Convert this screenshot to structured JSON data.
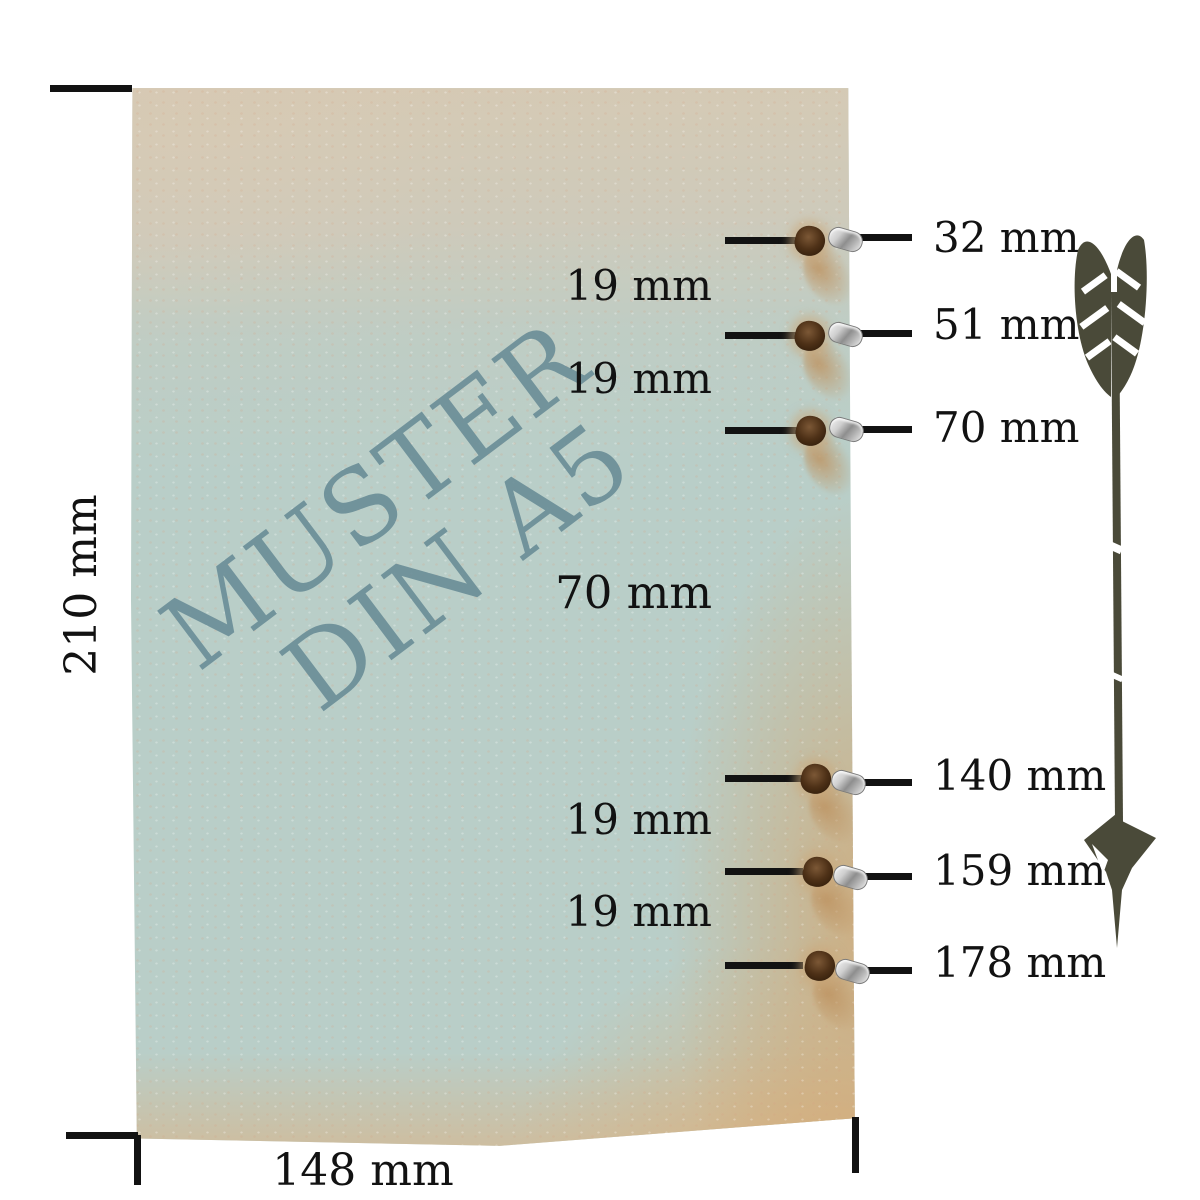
{
  "diagram": {
    "title_semantic": "DIN A5 sample sheet hole spacing diagram",
    "background_color": "#ffffff",
    "line_color": "#121212"
  },
  "paper": {
    "watermark_line1": "MUSTER",
    "watermark_line2": "DIN A5",
    "watermark_color": "#6a8d97",
    "base_color": "#b9cec8",
    "top_tint": "#d7c9b3",
    "stain_tint": "#d2a877"
  },
  "dimensions": {
    "height_label": "210 mm",
    "width_label": "148 mm"
  },
  "holes": [
    {
      "label": "32 mm"
    },
    {
      "label": "51 mm"
    },
    {
      "label": "70 mm"
    },
    {
      "label": "140 mm"
    },
    {
      "label": "159 mm"
    },
    {
      "label": "178 mm"
    }
  ],
  "gaps": [
    {
      "label": "19 mm"
    },
    {
      "label": "19 mm"
    },
    {
      "label": "70 mm"
    },
    {
      "label": "19 mm"
    },
    {
      "label": "19 mm"
    }
  ],
  "arrow": {
    "color": "#4a4a39"
  }
}
